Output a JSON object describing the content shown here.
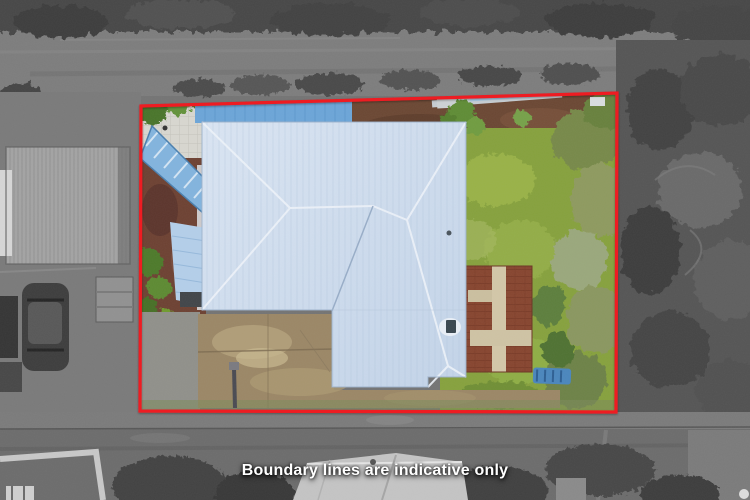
{
  "caption": {
    "text": "Boundary lines are indicative only"
  },
  "overlay": {
    "boundary_color": "#ee1b22"
  },
  "scene": {
    "roof_color": "#c3d4e9",
    "roof_highlight": "#dae5f3",
    "lawn_color": "#86a13d",
    "driveway_color": "#9b8766",
    "brick_patio_color": "#87452f",
    "blue_fence_color": "#6ca5d8"
  }
}
